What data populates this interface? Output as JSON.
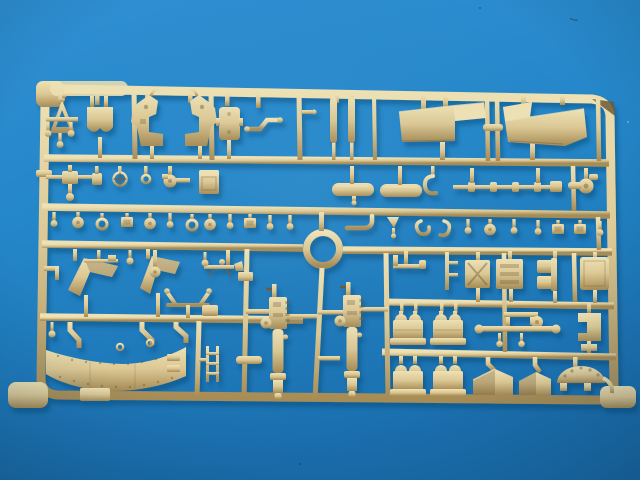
{
  "scene": {
    "description": "Photograph of a tan injection-moulded model-kit sprue (parts tree) lying on a blue surface",
    "subject": "plastic model sprue with many small parts",
    "plastic_color_name": "tan dark-yellow plastic",
    "background_name": "blue surface",
    "notable_parts": [
      "rectangular outer runner frame with rounded corners",
      "circular ring part at centre",
      "large curved riveted gun-shield band at lower left",
      "two vertical gun recoil assemblies at centre bottom",
      "two large angled hull panels at upper right",
      "two horizontal fuel-tank cylinders",
      "rows of small pins, discs, eyelets and boxes",
      "semicircular drilled dome at lower right"
    ]
  },
  "colors": {
    "background_light": "#2f8fd2",
    "background_mid": "#2487c9",
    "background_dark": "#1a6fae",
    "plastic_light": "#efe2b4",
    "plastic_mid": "#dcc894",
    "plastic_shadow": "#a78c55",
    "plastic_dark": "#6f5a35",
    "cast_shadow": "#0a3c66"
  }
}
